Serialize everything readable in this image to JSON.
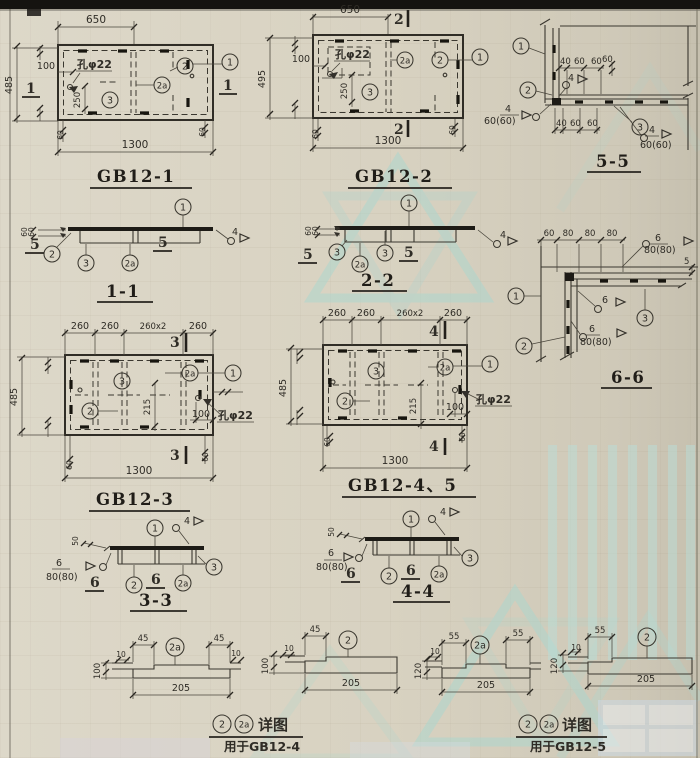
{
  "page": {
    "paper": "#d8d2c1",
    "ink": "#34312a",
    "watermark": "#a9d6cf"
  },
  "drawings": {
    "gb12_1": {
      "title": "GB12-1",
      "section_mark": "1",
      "hole_label": "孔φ22",
      "callouts": {
        "c1": "1",
        "c2": "2",
        "c2a": "2a",
        "c3": "3"
      },
      "dims": {
        "top": "650",
        "bottom": "1300",
        "left": "485",
        "inset": "100",
        "inner": "250",
        "edge_b": "60"
      }
    },
    "gb12_2": {
      "title": "GB12-2",
      "section_mark": "2",
      "hole_label": "孔φ22",
      "callouts": {
        "c1": "1",
        "c2": "2",
        "c2a": "2a",
        "c3": "3"
      },
      "dims": {
        "top": "650",
        "bottom": "1300",
        "left": "495",
        "inset": "100",
        "inner": "250",
        "edge_b": "60"
      }
    },
    "gb12_3": {
      "title": "GB12-3",
      "section_mark": "3",
      "hole_label": "孔φ22",
      "callouts": {
        "c1": "1",
        "c2": "2",
        "c2a": "2a",
        "c3": "3"
      },
      "dims": {
        "top": [
          "260",
          "260",
          "260x2",
          "260"
        ],
        "bottom": "1300",
        "left": "485",
        "v": "215",
        "h": "100",
        "edge_b": "60"
      }
    },
    "gb12_45": {
      "title": "GB12-4、5",
      "section_mark": "4",
      "hole_label": "孔φ22",
      "callouts": {
        "c1": "1",
        "c2": "2",
        "c2a": "2a",
        "c3": "3"
      },
      "dims": {
        "top": [
          "260",
          "260",
          "260x2",
          "260"
        ],
        "bottom": "1300",
        "left": "485",
        "v": "215",
        "h": "100",
        "edge_b": "60"
      }
    },
    "sec_1_1": {
      "title": "1-1",
      "cut_mark": "5",
      "ref": "4",
      "side_dim": "60",
      "callouts": {
        "c1": "1",
        "c2": "2",
        "c3": "3",
        "c2a": "2a"
      }
    },
    "sec_2_2": {
      "title": "2-2",
      "cut_mark": "5",
      "ref": "4",
      "side_dim": "60",
      "callouts": {
        "c1": "1",
        "c3a": "3",
        "c2a": "2a",
        "c3b": "3"
      }
    },
    "sec_3_3": {
      "title": "3-3",
      "cut_mark": "6",
      "ref": "4",
      "side_dim": "50",
      "weld": {
        "size": "6",
        "len": "80(80)"
      },
      "callouts": {
        "c1": "1",
        "c2": "2",
        "c2a": "2a",
        "c3": "3"
      }
    },
    "sec_4_4": {
      "title": "4-4",
      "cut_mark": "6",
      "ref": "4",
      "side_dim": "50",
      "weld": {
        "size": "6",
        "len": "80(80)"
      },
      "callouts": {
        "c1": "1",
        "c2": "2",
        "c2a": "2a",
        "c3": "3"
      }
    },
    "sec_5_5": {
      "title": "5-5",
      "dims_top": [
        "40",
        "60",
        "60"
      ],
      "dims_bottom": [
        "40",
        "60",
        "60"
      ],
      "dim_edge": "60",
      "weld": {
        "size": "4",
        "len": "60(60)"
      },
      "callouts": {
        "c1": "1",
        "c2": "2",
        "c3": "3"
      }
    },
    "sec_6_6": {
      "title": "6-6",
      "dims_top": [
        "60",
        "80",
        "80",
        "80"
      ],
      "dim_gap": "5",
      "weld": {
        "size": "6",
        "len": "80(80)"
      },
      "callouts": {
        "c1": "1",
        "c2": "2",
        "c3": "3"
      }
    }
  },
  "details": {
    "d1": {
      "callout": "2a",
      "end_left": "45",
      "end_right": "45",
      "length": "205",
      "height": "100",
      "lip": "10"
    },
    "d2": {
      "callout": "2",
      "end_left": "45",
      "length": "205",
      "height": "100",
      "lip": "10"
    },
    "d3": {
      "callout": "2a",
      "end_left": "55",
      "end_right": "55",
      "length": "205",
      "height": "120",
      "lip": "10"
    },
    "d4": {
      "callout": "2",
      "end_left": "55",
      "length": "205",
      "height": "120",
      "lip": "10"
    },
    "label_left": {
      "c2": "2",
      "c2a": "2a",
      "caption": "详图",
      "usage": "用于GB12-4"
    },
    "label_right": {
      "c2": "2",
      "c2a": "2a",
      "caption": "详图",
      "usage": "用于GB12-5"
    }
  }
}
